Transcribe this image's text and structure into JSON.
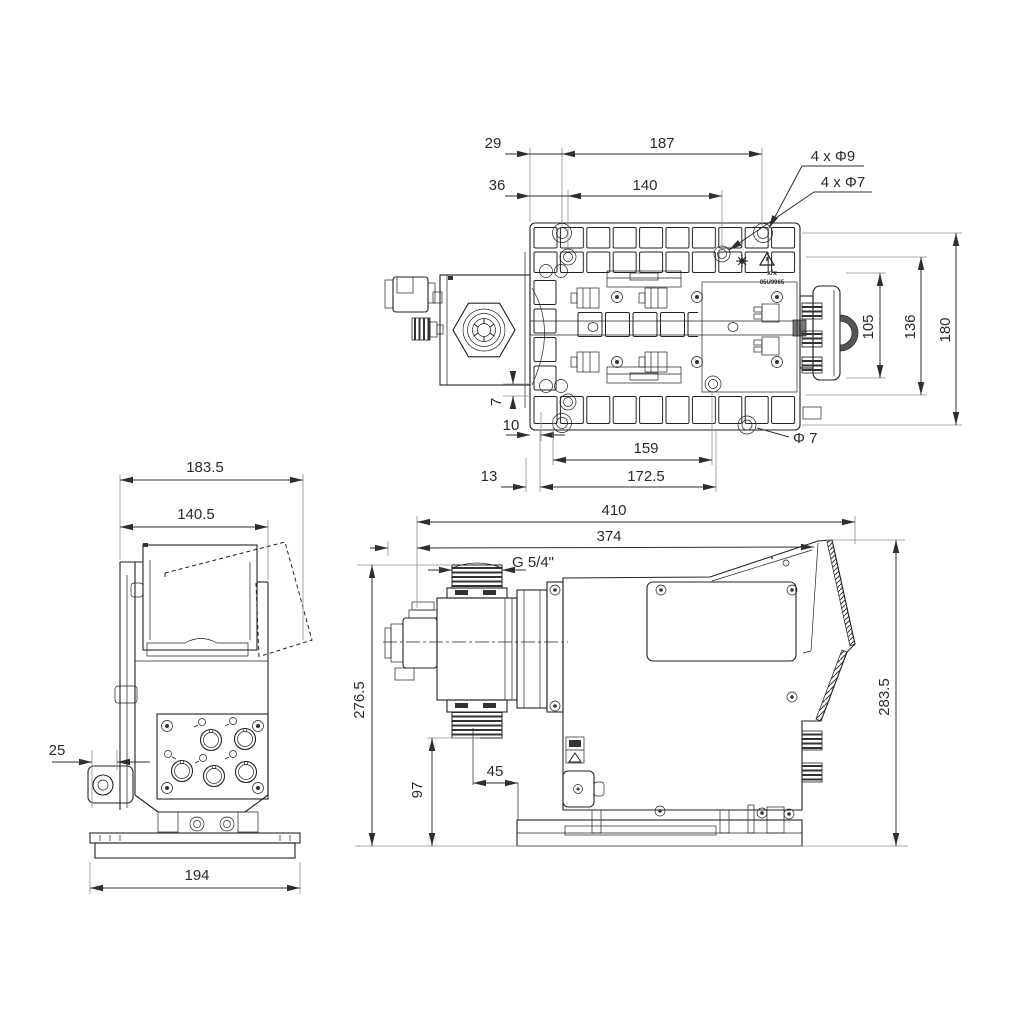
{
  "palette": {
    "line": "#222222",
    "dim_text": "#2b2b2b",
    "ext_line": "#8f8f8f"
  },
  "top_view": {
    "label": "Top view (mounting plate)",
    "dims": {
      "d29": "29",
      "d187": "187",
      "d36": "36",
      "d140": "140",
      "holes_9": "4 x Φ9",
      "holes_7": "4 x Φ7",
      "d105": "105",
      "d136": "136",
      "d180": "180",
      "d7": "7",
      "d10": "10",
      "d159": "159",
      "dia7": "Φ 7",
      "d13": "13",
      "d172_5": "172.5"
    },
    "marking": {
      "line1": "x/x",
      "line2": "05U9965"
    },
    "icons": [
      "sun-icon",
      "warning-triangle-icon"
    ]
  },
  "front_view": {
    "label": "Front view",
    "dims": {
      "d183_5": "183.5",
      "d140_5": "140.5",
      "d25": "25",
      "d194": "194"
    }
  },
  "side_view": {
    "label": "Side view",
    "dims": {
      "d410": "410",
      "d374": "374",
      "thread": "G 5/4\"",
      "d276_5": "276.5",
      "d283_5": "283.5",
      "d97": "97",
      "d45": "45"
    }
  }
}
